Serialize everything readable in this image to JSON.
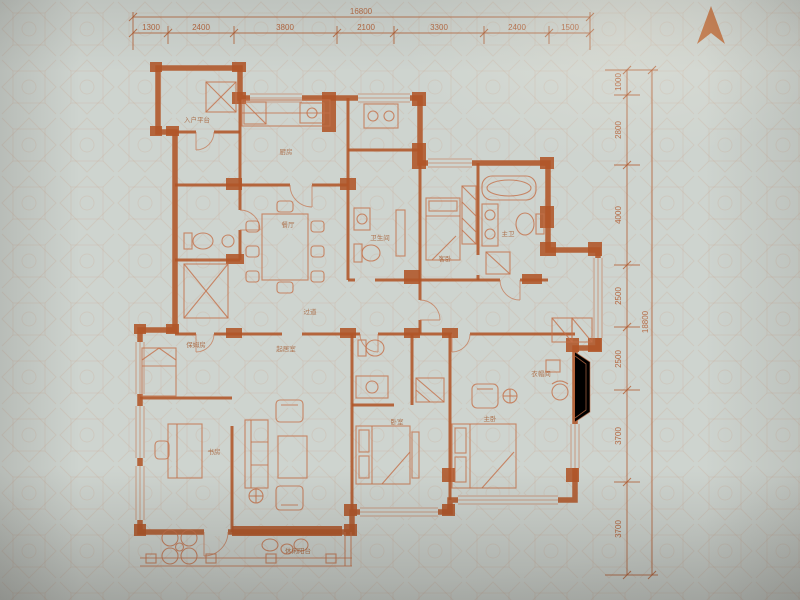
{
  "colors": {
    "paper": "#ced4cf",
    "pattern": "#c89a82",
    "ink": "#b05528",
    "ink_soft": "#c4714a",
    "label": "#a3572b"
  },
  "icons": {
    "north_arrow": "▲"
  },
  "dimensions": {
    "top": {
      "total": "16800",
      "segments": [
        "1300",
        "2400",
        "3800",
        "2100",
        "3300",
        "2400",
        "1500"
      ]
    },
    "right": {
      "total": "18800",
      "segments": [
        "1000",
        "2800",
        "4000",
        "2500",
        "2500",
        "3700",
        "3700"
      ]
    }
  },
  "rooms": {
    "entry": "入户平台",
    "kitchen": "厨房",
    "dining": "餐厅",
    "guest_bath": "卫生间",
    "guest_bed": "客卧",
    "master_bath": "主卫",
    "hall": "过道",
    "maid": "保姆房",
    "family": "起居室",
    "study": "书房",
    "bedroom": "卧室",
    "master": "主卧",
    "closet": "衣帽间",
    "balcony": "休闲阳台"
  }
}
